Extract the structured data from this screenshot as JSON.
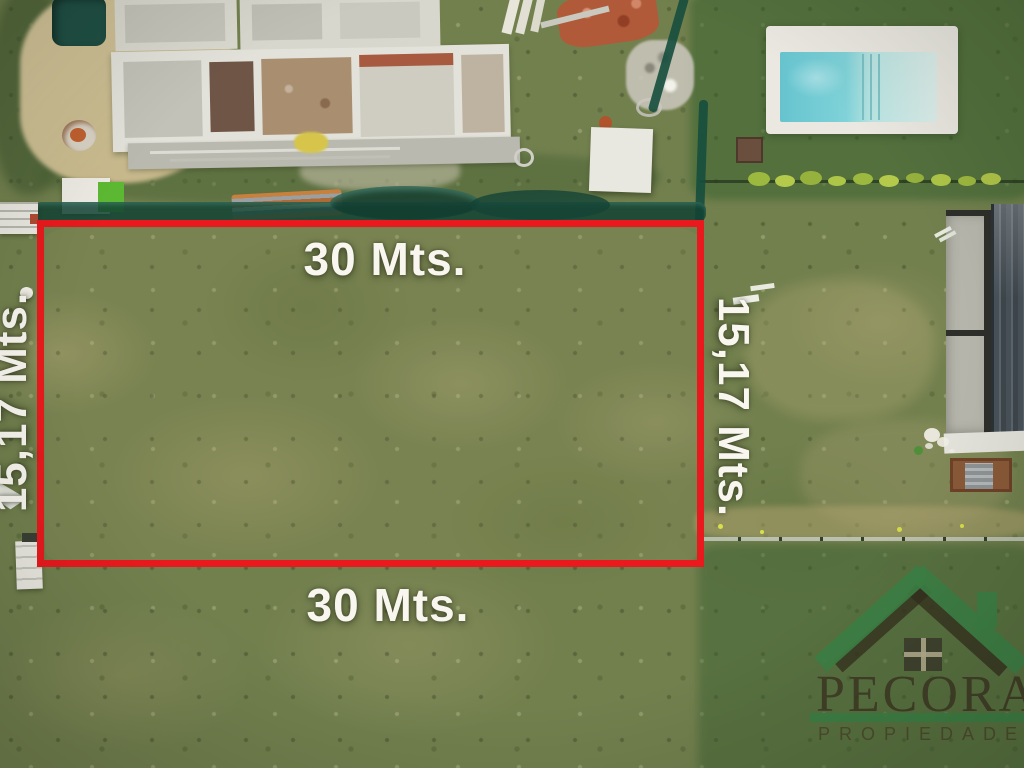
{
  "scene": {
    "description": "aerial-drone-photo-of-vacant-grass-lot",
    "features": {
      "top_left": "house-under-construction",
      "top_right": "swimming-pool",
      "right": "neighbor-house-roof",
      "field": "grass-lot-marked-for-sale"
    }
  },
  "lot": {
    "boundary_color": "#e9191d",
    "labels": {
      "top": "30 Mts.",
      "bottom": "30 Mts.",
      "left": "15,17 Mts.",
      "right": "15,17 Mts."
    }
  },
  "watermark": {
    "name": "PECORA",
    "tagline": "PROPIEDADES",
    "brand_green": "#3c8045",
    "brand_dark": "#3e3823"
  }
}
